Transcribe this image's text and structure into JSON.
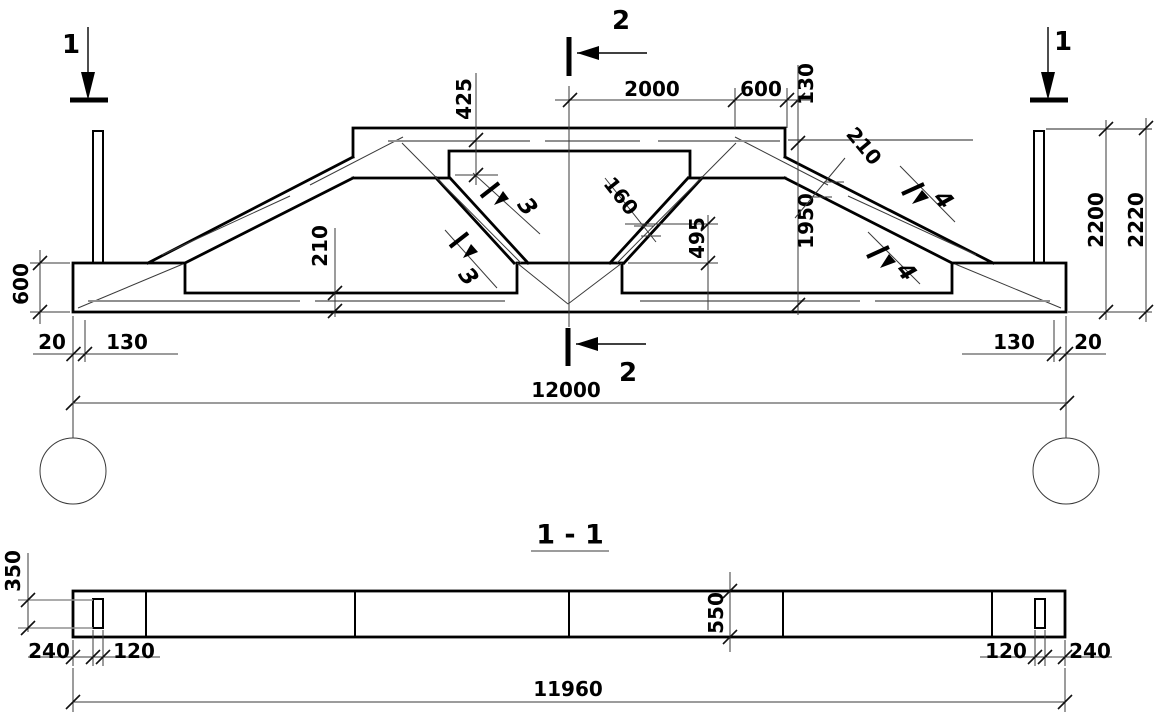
{
  "drawing": {
    "background": "#ffffff",
    "line_color": "#000000",
    "thin_line_color": "#3a3a3a",
    "rebar_line_color": "#909090"
  },
  "elevation": {
    "marker_1_left": "1",
    "marker_1_right": "1",
    "marker_2_top": "2",
    "marker_2_bottom": "2",
    "section_3_upper": "3",
    "section_3_lower": "3",
    "section_4_upper": "4",
    "section_4_lower": "4",
    "dims": {
      "top_2000": "2000",
      "top_600": "600",
      "top_130": "130",
      "v_425": "425",
      "slope_210": "210",
      "web_160": "160",
      "v_1950": "1950",
      "v_495": "495",
      "right_2200": "2200",
      "right_2220": "2220",
      "left_600": "600",
      "chord_210": "210",
      "bottom_left_20": "20",
      "bottom_left_130": "130",
      "bottom_right_130": "130",
      "bottom_right_20": "20",
      "span_12000": "12000"
    }
  },
  "section_view": {
    "title": "1 - 1",
    "dims": {
      "hole_350": "350",
      "left_240": "240",
      "left_120": "120",
      "width_550": "550",
      "right_120": "120",
      "right_240": "240",
      "length_11960": "11960"
    }
  }
}
